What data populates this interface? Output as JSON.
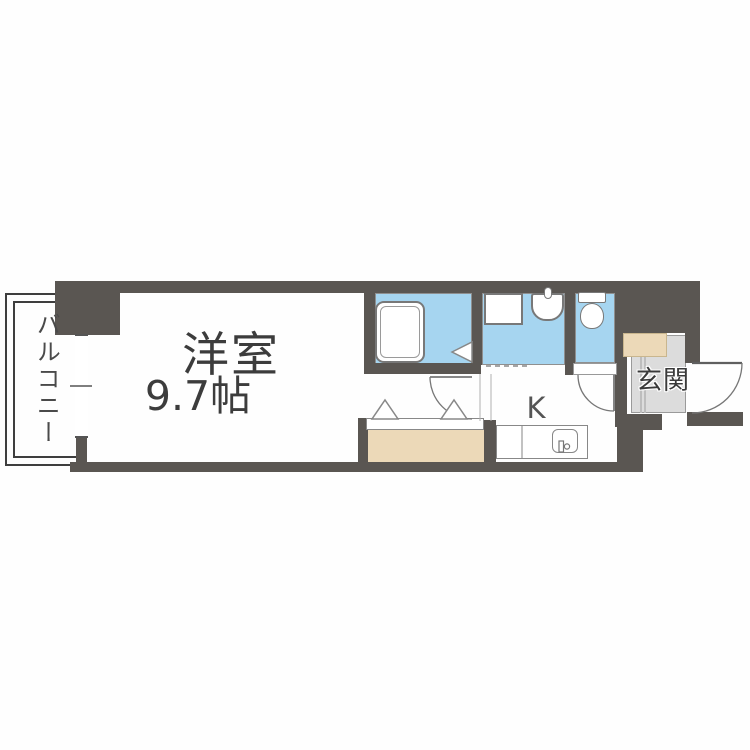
{
  "floorplan": {
    "labels": {
      "balcony": "バルコニー",
      "main_room": "洋室",
      "main_room_size": "9.7帖",
      "kitchen": "K",
      "entrance": "玄関"
    },
    "colors": {
      "wall": "#5a5652",
      "water": "#a6d5f0",
      "wood": "#ecd9b8",
      "tataki": "#dcdcdc",
      "line": "#808080",
      "text-main": "#3c3c3c"
    },
    "rooms": [
      "balcony",
      "western-room-9.7",
      "bathroom",
      "washroom-laundry",
      "toilet",
      "kitchen",
      "entrance-genkan",
      "closet"
    ],
    "fixtures": [
      "bathtub",
      "washing-machine-space",
      "washbasin",
      "toilet-bowl",
      "kitchen-counter",
      "kitchen-sink",
      "closet-folding-door",
      "window",
      "entrance-door",
      "interior-door",
      "toilet-door"
    ]
  }
}
